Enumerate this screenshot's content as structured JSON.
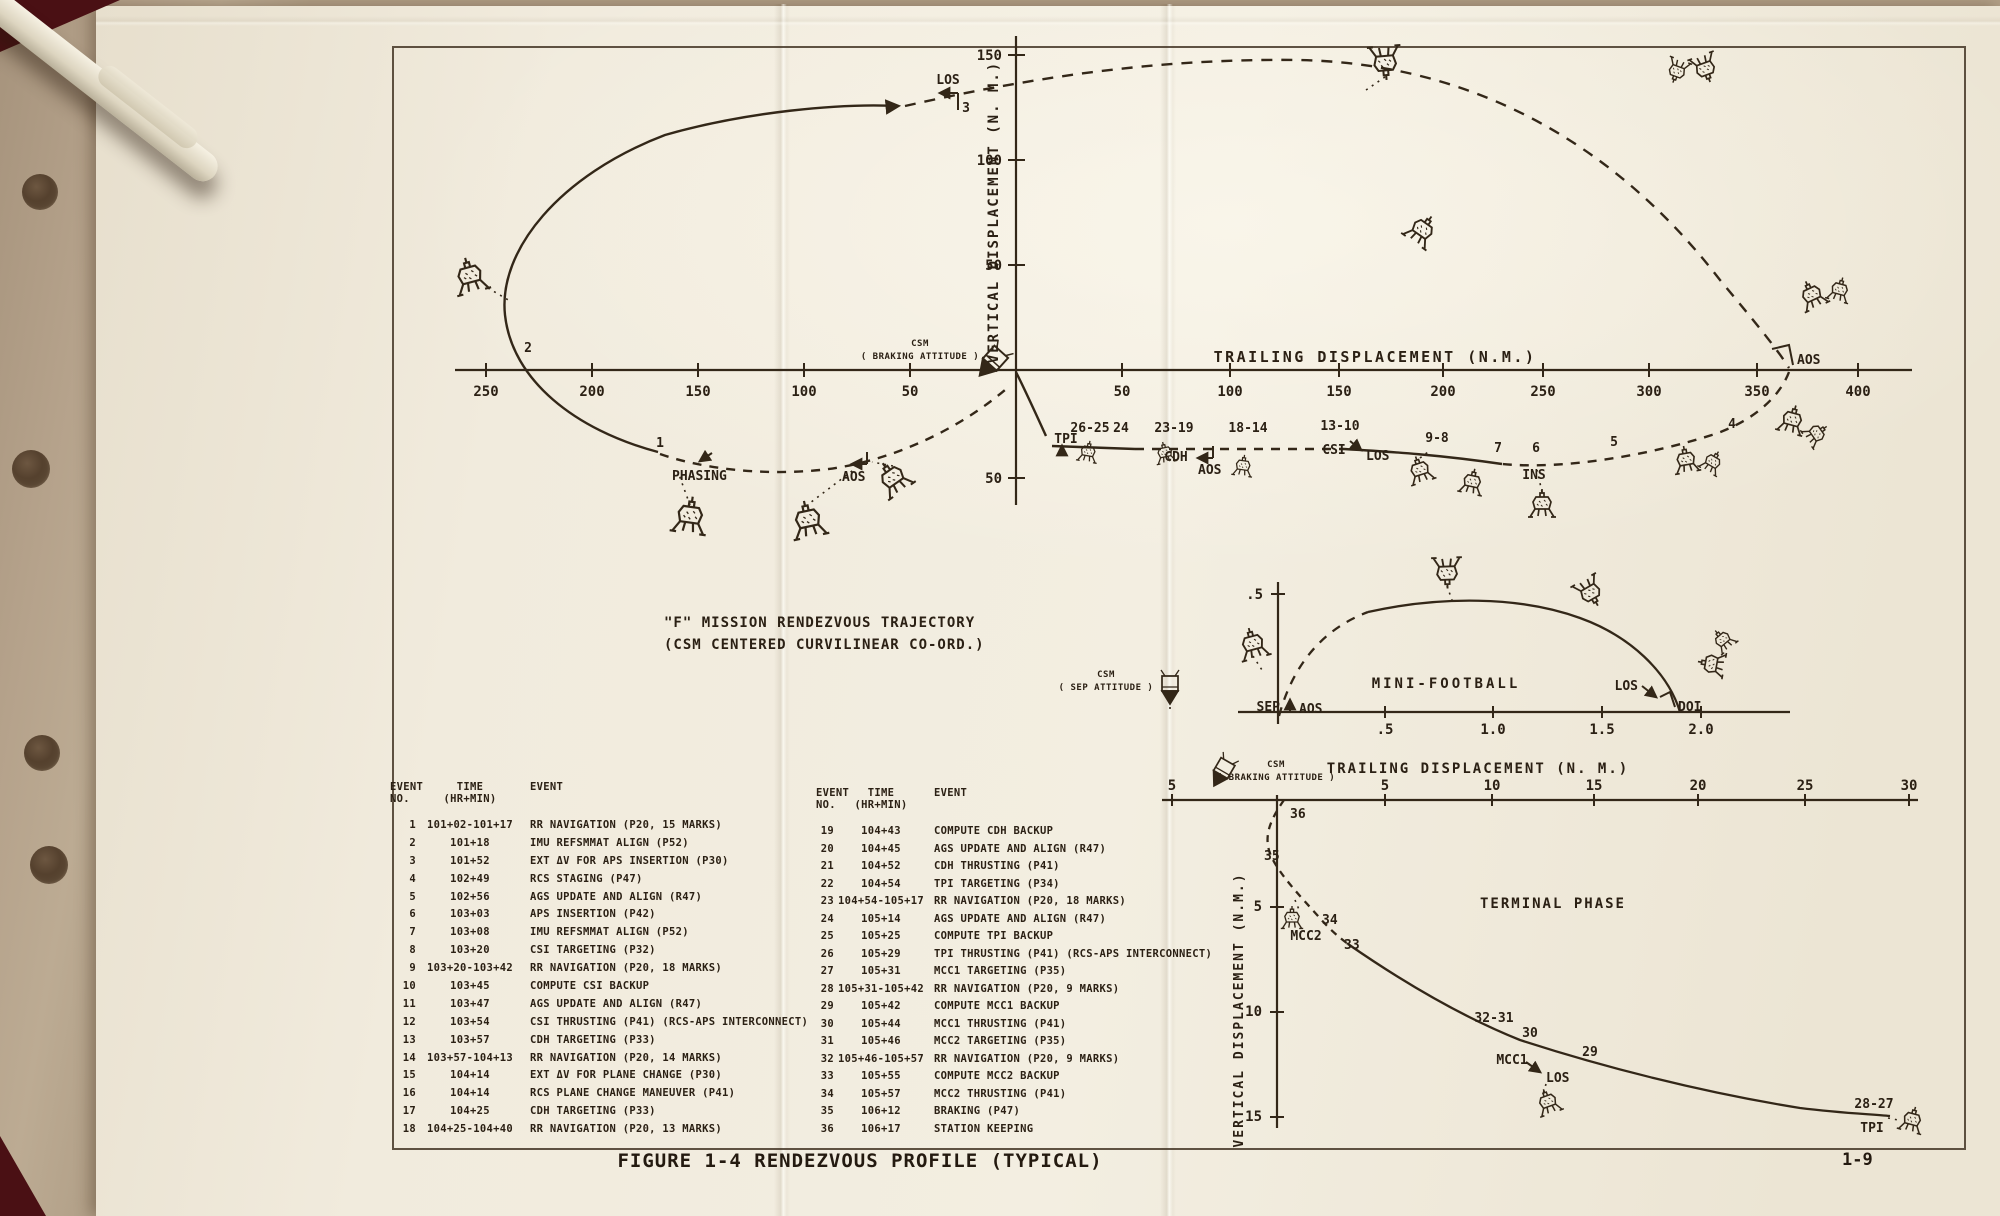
{
  "figure": {
    "title1": "\"F\" MISSION RENDEZVOUS TRAJECTORY",
    "title2": "(CSM CENTERED CURVILINEAR CO-ORD.)",
    "caption": "FIGURE 1-4 RENDEZVOUS PROFILE (TYPICAL)",
    "page_number": "1-9"
  },
  "main": {
    "xlabel": "TRAILING  DISPLACEMENT (N.M.)",
    "ylabel": "VERTICAL  DISPLACEMENT (N. M.)",
    "x_ticks": [
      "250",
      "200",
      "150",
      "100",
      "50",
      "50",
      "100",
      "150",
      "200",
      "250",
      "300",
      "350",
      "400"
    ],
    "y_ticks": [
      "150",
      "100",
      "50",
      "50"
    ],
    "labels": {
      "los_top": "LOS",
      "n3": "3",
      "n2": "2",
      "n1": "1",
      "phasing": "PHASING",
      "aos_left": "AOS",
      "aos_mid": "AOS",
      "aos_right": "AOS",
      "csm": "CSM",
      "csm_att": "( BRAKING ATTITUDE )",
      "tpi": "TPI",
      "g2625": "26-25",
      "g24": "24",
      "g2319": "23-19",
      "cdh": "CDH",
      "g1814": "18-14",
      "g1310": "13-10",
      "csi": "CSI",
      "los_mid": "LOS",
      "g98": "9-8",
      "n7": "7",
      "n6": "6",
      "ins": "INS",
      "n5": "5",
      "n4": "4"
    }
  },
  "mini": {
    "title": "MINI-FOOTBALL",
    "xlabel": "TRAILING  DISPLACEMENT (N. M.)",
    "x_ticks": [
      ".5",
      "1.0",
      "1.5",
      "2.0"
    ],
    "y_ticks": [
      ".5"
    ],
    "labels": {
      "sep": "SEP",
      "aos": "AOS",
      "los": "LOS",
      "doi": "DOI",
      "csm": "CSM",
      "csm_att": "( SEP ATTITUDE )"
    }
  },
  "term": {
    "title": "TERMINAL  PHASE",
    "ylabel": "VERTICAL  DISPLACEMENT  (N.M.)",
    "x_ticks": [
      "5",
      "5",
      "10",
      "15",
      "20",
      "25",
      "30"
    ],
    "y_ticks": [
      "5",
      "10",
      "15"
    ],
    "labels": {
      "n36": "36",
      "n35": "35",
      "n34": "34",
      "mcc2": "MCC2",
      "n33": "33",
      "g3231": "32-31",
      "n30": "30",
      "mcc1": "MCC1",
      "los": "LOS",
      "n29": "29",
      "g2827": "28-27",
      "tpi": "TPI",
      "csm": "CSM",
      "csm_att": "( BRAKING ATTITUDE )"
    }
  },
  "tables": {
    "left": {
      "h1": "EVENT",
      "h1b": "NO.",
      "h2": "TIME",
      "h2b": "(HR+MIN)",
      "h3": "EVENT",
      "rows": [
        {
          "no": "1",
          "time": "101+02-101+17",
          "event": "RR NAVIGATION (P20, 15 MARKS)"
        },
        {
          "no": "2",
          "time": "101+18",
          "event": "IMU REFSMMAT ALIGN (P52)"
        },
        {
          "no": "3",
          "time": "101+52",
          "event": "EXT ΔV FOR APS INSERTION (P30)"
        },
        {
          "no": "4",
          "time": "102+49",
          "event": "RCS STAGING (P47)"
        },
        {
          "no": "5",
          "time": "102+56",
          "event": "AGS UPDATE AND ALIGN (R47)"
        },
        {
          "no": "6",
          "time": "103+03",
          "event": "APS INSERTION (P42)"
        },
        {
          "no": "7",
          "time": "103+08",
          "event": "IMU REFSMMAT ALIGN (P52)"
        },
        {
          "no": "8",
          "time": "103+20",
          "event": "CSI TARGETING (P32)"
        },
        {
          "no": "9",
          "time": "103+20-103+42",
          "event": "RR NAVIGATION (P20, 18 MARKS)"
        },
        {
          "no": "10",
          "time": "103+45",
          "event": "COMPUTE CSI BACKUP"
        },
        {
          "no": "11",
          "time": "103+47",
          "event": "AGS UPDATE AND ALIGN (R47)"
        },
        {
          "no": "12",
          "time": "103+54",
          "event": "CSI THRUSTING (P41) (RCS-APS INTERCONNECT)"
        },
        {
          "no": "13",
          "time": "103+57",
          "event": "CDH TARGETING (P33)"
        },
        {
          "no": "14",
          "time": "103+57-104+13",
          "event": "RR NAVIGATION (P20, 14 MARKS)"
        },
        {
          "no": "15",
          "time": "104+14",
          "event": "EXT ΔV FOR PLANE CHANGE (P30)"
        },
        {
          "no": "16",
          "time": "104+14",
          "event": "RCS PLANE CHANGE MANEUVER (P41)"
        },
        {
          "no": "17",
          "time": "104+25",
          "event": "CDH TARGETING (P33)"
        },
        {
          "no": "18",
          "time": "104+25-104+40",
          "event": "RR NAVIGATION (P20, 13 MARKS)"
        }
      ]
    },
    "right": {
      "h1": "EVENT",
      "h1b": "NO.",
      "h2": "TIME",
      "h2b": "(HR+MIN)",
      "h3": "EVENT",
      "rows": [
        {
          "no": "19",
          "time": "104+43",
          "event": "COMPUTE CDH BACKUP"
        },
        {
          "no": "20",
          "time": "104+45",
          "event": "AGS UPDATE AND ALIGN (R47)"
        },
        {
          "no": "21",
          "time": "104+52",
          "event": "CDH THRUSTING (P41)"
        },
        {
          "no": "22",
          "time": "104+54",
          "event": "TPI TARGETING (P34)"
        },
        {
          "no": "23",
          "time": "104+54-105+17",
          "event": "RR NAVIGATION (P20, 18 MARKS)"
        },
        {
          "no": "24",
          "time": "105+14",
          "event": "AGS UPDATE AND ALIGN (R47)"
        },
        {
          "no": "25",
          "time": "105+25",
          "event": "COMPUTE TPI BACKUP"
        },
        {
          "no": "26",
          "time": "105+29",
          "event": "TPI THRUSTING (P41) (RCS-APS INTERCONNECT)"
        },
        {
          "no": "27",
          "time": "105+31",
          "event": "MCC1 TARGETING (P35)"
        },
        {
          "no": "28",
          "time": "105+31-105+42",
          "event": "RR NAVIGATION (P20, 9 MARKS)"
        },
        {
          "no": "29",
          "time": "105+42",
          "event": "COMPUTE MCC1 BACKUP"
        },
        {
          "no": "30",
          "time": "105+44",
          "event": "MCC1 THRUSTING (P41)"
        },
        {
          "no": "31",
          "time": "105+46",
          "event": "MCC2 TARGETING (P35)"
        },
        {
          "no": "32",
          "time": "105+46-105+57",
          "event": "RR NAVIGATION (P20, 9 MARKS)"
        },
        {
          "no": "33",
          "time": "105+55",
          "event": "COMPUTE MCC2 BACKUP"
        },
        {
          "no": "34",
          "time": "105+57",
          "event": "MCC2 THRUSTING (P41)"
        },
        {
          "no": "35",
          "time": "106+12",
          "event": "BRAKING (P47)"
        },
        {
          "no": "36",
          "time": "106+17",
          "event": "STATION KEEPING"
        }
      ]
    }
  },
  "chart_data": [
    {
      "type": "line",
      "title": "\"F\" MISSION RENDEZVOUS TRAJECTORY (CSM CENTERED CURVILINEAR CO-ORD.)",
      "xlabel": "TRAILING DISPLACEMENT (N.M.)",
      "ylabel": "VERTICAL DISPLACEMENT (N. M.)",
      "x_range": [
        -250,
        400
      ],
      "y_range": [
        -50,
        150
      ],
      "grid": false,
      "x_tick_values": [
        -250,
        -200,
        -150,
        -100,
        -50,
        50,
        100,
        150,
        200,
        250,
        300,
        350,
        400
      ],
      "y_tick_values": [
        150,
        100,
        50,
        -50
      ],
      "description": "Closed orbital trace (part solid, part dashed) looping around the CSM at the origin, with numbered mission events.",
      "annotations": [
        {
          "label": "1 / PHASING",
          "x": -169,
          "y": -39
        },
        {
          "label": "2",
          "x": -227,
          "y": 10
        },
        {
          "label": "3 / LOS",
          "x": -25,
          "y": 126
        },
        {
          "label": "AOS (left)",
          "x": -75,
          "y": -44
        },
        {
          "label": "TPI",
          "x": 22,
          "y": -37
        },
        {
          "label": "26-25",
          "x": 35,
          "y": -30
        },
        {
          "label": "24",
          "x": 48,
          "y": -30
        },
        {
          "label": "23-19 / CDH",
          "x": 76,
          "y": -35
        },
        {
          "label": "AOS (mid)",
          "x": 89,
          "y": -41
        },
        {
          "label": "18-14",
          "x": 110,
          "y": -33
        },
        {
          "label": "13-10 / CSI / LOS",
          "x": 155,
          "y": -37
        },
        {
          "label": "9-8",
          "x": 196,
          "y": -38
        },
        {
          "label": "7",
          "x": 228,
          "y": -44
        },
        {
          "label": "6 / INS",
          "x": 246,
          "y": -45
        },
        {
          "label": "5",
          "x": 283,
          "y": -41
        },
        {
          "label": "4",
          "x": 339,
          "y": -29
        },
        {
          "label": "AOS (right)",
          "x": 365,
          "y": 0
        }
      ]
    },
    {
      "type": "line",
      "title": "MINI-FOOTBALL",
      "xlabel": "TRAILING DISPLACEMENT (N. M.)",
      "x_range": [
        0,
        2.0
      ],
      "y_range": [
        0,
        0.5
      ],
      "grid": false,
      "x_tick_values": [
        0.5,
        1.0,
        1.5,
        2.0
      ],
      "y_tick_values": [
        0.5
      ],
      "description": "Half-football relative-motion arc from SEP/AOS at origin to DOI.",
      "annotations": [
        {
          "label": "SEP",
          "x": 0,
          "y": 0
        },
        {
          "label": "AOS",
          "x": 0.08,
          "y": 0
        },
        {
          "label": "apex",
          "x": 0.95,
          "y": 0.47
        },
        {
          "label": "LOS",
          "x": 1.7,
          "y": 0.12
        },
        {
          "label": "DOI",
          "x": 1.86,
          "y": 0
        }
      ]
    },
    {
      "type": "line",
      "title": "TERMINAL PHASE",
      "xlabel": "TRAILING DISPLACEMENT (N.M.) (shared axis above)",
      "ylabel": "VERTICAL DISPLACEMENT (N.M.) (increasing downward)",
      "x_range": [
        -5,
        30
      ],
      "y_range": [
        0,
        15
      ],
      "grid": false,
      "x_tick_values": [
        -5,
        5,
        10,
        15,
        20,
        25,
        30
      ],
      "y_tick_values": [
        5,
        10,
        15
      ],
      "description": "Terminal phase trace from station keeping (36) at origin out to TPI (28-27).",
      "annotations": [
        {
          "label": "36",
          "x": 0.5,
          "y": 0.6
        },
        {
          "label": "35",
          "x": -0.2,
          "y": 2.7
        },
        {
          "label": "34 / MCC2",
          "x": 2.0,
          "y": 5.6
        },
        {
          "label": "33",
          "x": 3.2,
          "y": 6.7
        },
        {
          "label": "32-31",
          "x": 10.0,
          "y": 10.7
        },
        {
          "label": "30 / MCC1",
          "x": 11.8,
          "y": 11.4
        },
        {
          "label": "LOS",
          "x": 12.8,
          "y": 13.0
        },
        {
          "label": "29",
          "x": 14.8,
          "y": 12.3
        },
        {
          "label": "28-27 / TPI",
          "x": 28.6,
          "y": 14.9
        }
      ]
    }
  ]
}
